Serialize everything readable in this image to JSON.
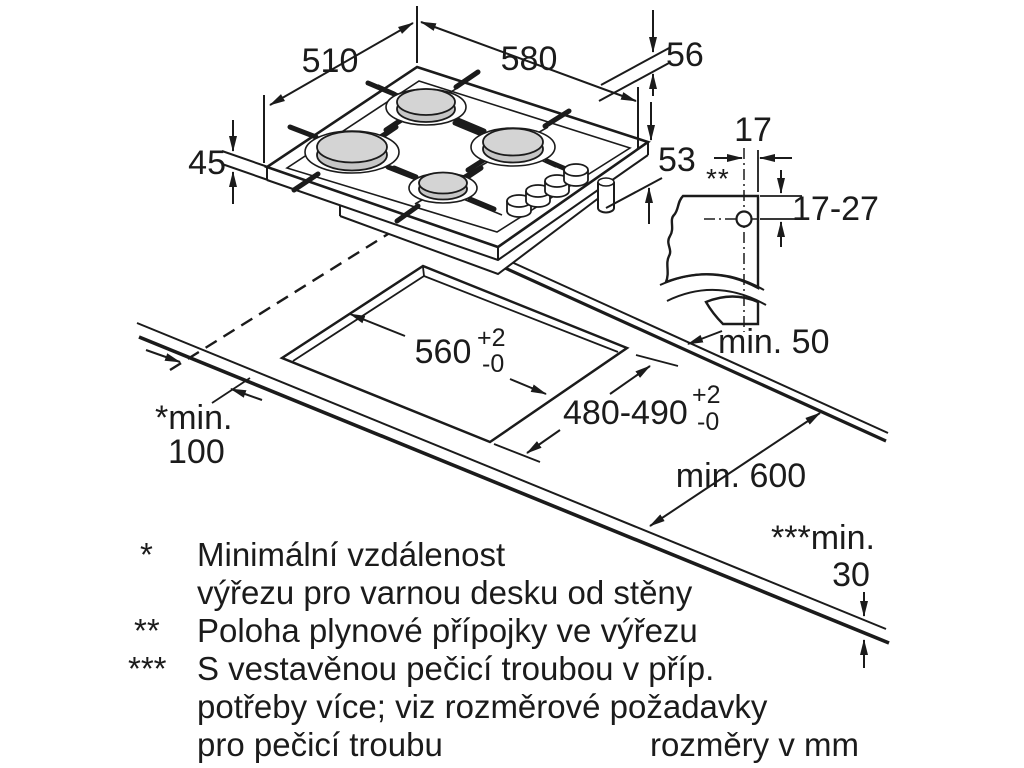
{
  "diagram_title_hidden": "",
  "units_note": "rozměry v mm",
  "hob": {
    "depth": "510",
    "width": "580",
    "height_top_right": "56",
    "height_left": "45",
    "height_bottom_right": "53"
  },
  "gas_detail": {
    "offset_in_cutout": "17",
    "marker": "**",
    "depth_range": "17-27",
    "min_side_distance": "min. 50"
  },
  "cutout": {
    "width": "560",
    "width_tol_plus": "+2",
    "width_tol_minus": "-0",
    "depth": "480-490",
    "depth_tol_plus": "+2",
    "depth_tol_minus": "-0"
  },
  "worktop": {
    "min_wall_label": "*min.",
    "min_wall_value": "100",
    "min_depth": "min. 600",
    "min_oven_gap_label": "***min.",
    "min_oven_gap_value": "30"
  },
  "footnotes": [
    {
      "marker": "*",
      "line1": "Minimální vzdálenost",
      "line2": "výřezu pro varnou desku od stěny"
    },
    {
      "marker": "**",
      "line1": "Poloha plynové přípojky ve výřezu"
    },
    {
      "marker": "***",
      "line1": "S vestavěnou pečicí troubou v příp.",
      "line2": "potřeby více; viz rozměrové požadavky",
      "line3": "pro pečicí troubu"
    }
  ],
  "colors": {
    "ink": "#1b1b1b",
    "burner_cap": "#c6c6c6",
    "burner_cap_top": "#d4d4d4",
    "paper": "#ffffff"
  }
}
